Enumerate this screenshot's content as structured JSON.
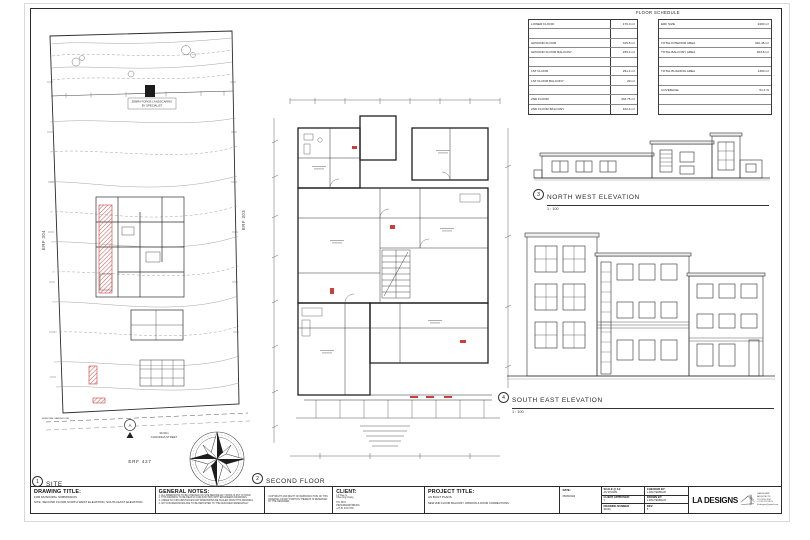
{
  "floor_schedule": {
    "title": "FLOOR SCHEDULE",
    "left_rows": [
      {
        "label": "LOWER FLOOR",
        "value": "170.0 m²"
      },
      {
        "label": "",
        "value": ""
      },
      {
        "label": "GROUND FLOOR",
        "value": "315.8 m²"
      },
      {
        "label": "GROUND FLOOR BALCONY",
        "value": "239.4 m²"
      },
      {
        "label": "",
        "value": ""
      },
      {
        "label": "1ST FLOOR",
        "value": "291.4 m²"
      },
      {
        "label": "1ST FLOOR BALCONY",
        "value": "29 m²"
      },
      {
        "label": "",
        "value": ""
      },
      {
        "label": "2ND FLOOR",
        "value": "333.75 m²"
      },
      {
        "label": "2ND FLOOR BALCONY",
        "value": "162.4 m²"
      }
    ],
    "right_rows": [
      {
        "label": "ERF SIZE",
        "value": "2400 m²"
      },
      {
        "label": "",
        "value": ""
      },
      {
        "label": "TOTAL INTERIOR AREA",
        "value": "910.45 m²"
      },
      {
        "label": "TOTAL BALCONY AREA",
        "value": "403.8 m²"
      },
      {
        "label": "",
        "value": ""
      },
      {
        "label": "TOTAL BUILDING AREA",
        "value": "1300 m²"
      },
      {
        "label": "",
        "value": ""
      },
      {
        "label": "COVERAGE",
        "value": "51.3 %"
      },
      {
        "label": "",
        "value": ""
      },
      {
        "label": "",
        "value": ""
      }
    ]
  },
  "drawings": {
    "site": {
      "number": "1",
      "title": "SITE",
      "scale": "1 : 200",
      "erf_left": "ERF 304",
      "erf_right": "ERF 303",
      "erf_bottom": "ERF 427",
      "street_line1": "30.00m",
      "street_line2": "CHANDIGA STREET",
      "landscape_note_line1": "ZEBRA FORGE LANDSCAPING",
      "landscape_note_line2": "BY SPECIALIST",
      "garden_line": "MUNICIPAL GARDEN LINE",
      "section_marker": "A"
    },
    "second_floor": {
      "number": "2",
      "title": "SECOND FLOOR",
      "scale": "1 : 100"
    },
    "nw_elevation": {
      "number": "3",
      "title": "NORTH WEST ELEVATION",
      "scale": "1 : 100"
    },
    "se_elevation": {
      "number": "4",
      "title": "SOUTH EAST ELEVATION",
      "scale": "1 : 100"
    }
  },
  "title_block": {
    "drawing_title": {
      "header": "DRAWING TITLE:",
      "line1": "FOR MUNICIPAL SUBMISSION",
      "line2": "SITE, SECOND FLOOR,NORTH WEST ELEVATION, SOUTH EAST ELEVATION"
    },
    "general_notes": {
      "header": "GENERAL NOTES:",
      "notes": [
        "1. ALL DIMENSIONS TO BE CHECKED ON SITE BEFORE ANY WORK IS PUT IN HAND.",
        "2. THIS DRAWING TO BE READ IN CONJUNCTION WITH ENGINEERS DRAWINGS.",
        "3. UNDER NO CIRCUMSTANCES MAY DIMENSIONS BE SCALED FROM THIS DRAWING.",
        "4. ANY DISCREPANCIES ARE TO BE REPORTED TO THE DESIGNER IMMEDIATELY."
      ]
    },
    "copyright": "COPYRIGHT AND RIGHT OF REPRODUCTION OF THIS DRAWING OR ANY PORTION THEREOF IS RESERVED BY THE DESIGNER",
    "client": {
      "header": "CLIENT:",
      "lines": [
        "L.P Dee G",
        "Cheu-ling Chang",
        "P.O. BOX",
        "PIETERMARITZBURG",
        "+27 81 234 0739"
      ]
    },
    "project_title": {
      "header": "PROJECT TITLE:",
      "line1": "AS BUILT PLANS",
      "line2": "NEW 2ND FLOOR BALCONY, WINDOW & DOOR CORRECTIONS"
    },
    "date": {
      "label": "DATE:",
      "value": "05/05/2024"
    },
    "scale_a1": {
      "label": "SCALE @ A1:",
      "value": "AS SHOWN"
    },
    "checked_by": {
      "label": "CHECKED BY:",
      "value": "L.RAUTENBACH"
    },
    "client_approved": {
      "label": "CLIENT APPROVED:",
      "value": "Y"
    },
    "drawn_by": {
      "label": "DRAWN BY:",
      "value": "L.RAUTENBACH"
    },
    "drawing_number": {
      "label": "DRAWING NUMBER",
      "value": "SD/49"
    },
    "rev": {
      "label": "REV:",
      "value": "5"
    },
    "logo": {
      "name": "LA DESIGNS",
      "contact": [
        "LANDSCAPE ARCHITECTS",
        "P.O. BOX 4567",
        "+27 82 555 0123",
        "la.designs@gmail.com"
      ]
    }
  }
}
